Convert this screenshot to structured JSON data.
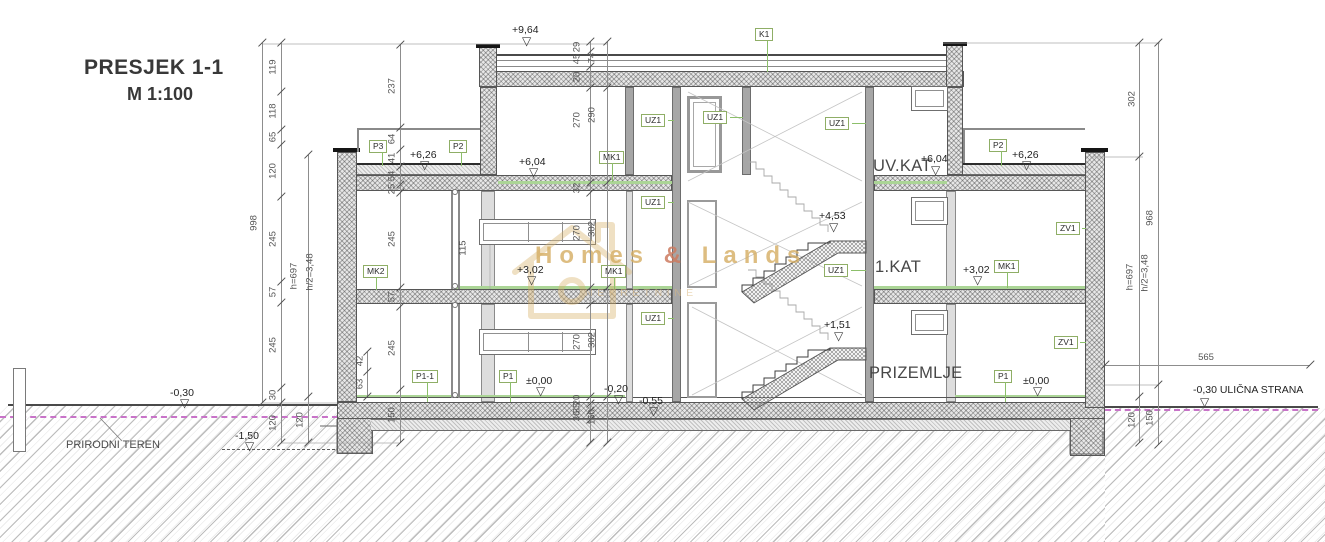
{
  "title": {
    "line1": "PRESJEK 1-1",
    "line2": "M 1:100"
  },
  "floor_names": [
    {
      "t": "UV.KAT",
      "x": 873,
      "y": 157
    },
    {
      "t": "1.KAT",
      "x": 875,
      "y": 258
    },
    {
      "t": "PRIZEMLJE",
      "x": 869,
      "y": 364
    }
  ],
  "level_symbol": "▽",
  "levels": [
    {
      "t": "+9,64",
      "x": 512,
      "y": 24,
      "tx": 522,
      "ty": 36
    },
    {
      "t": "+6,26",
      "x": 410,
      "y": 149,
      "tx": 420,
      "ty": 160
    },
    {
      "t": "+6,04",
      "x": 519,
      "y": 156,
      "tx": 529,
      "ty": 167
    },
    {
      "t": "+6,04",
      "x": 921,
      "y": 153,
      "tx": 931,
      "ty": 165
    },
    {
      "t": "+6,26",
      "x": 1012,
      "y": 149,
      "tx": 1022,
      "ty": 160
    },
    {
      "t": "+4,53",
      "x": 819,
      "y": 210,
      "tx": 829,
      "ty": 222
    },
    {
      "t": "+3,02",
      "x": 517,
      "y": 264,
      "tx": 527,
      "ty": 275
    },
    {
      "t": "+3,02",
      "x": 963,
      "y": 264,
      "tx": 973,
      "ty": 275
    },
    {
      "t": "+1,51",
      "x": 824,
      "y": 319,
      "tx": 834,
      "ty": 331
    },
    {
      "t": "±0,00",
      "x": 526,
      "y": 375,
      "tx": 536,
      "ty": 386
    },
    {
      "t": "±0,00",
      "x": 1023,
      "y": 375,
      "tx": 1033,
      "ty": 386
    },
    {
      "t": "-0,20",
      "x": 604,
      "y": 383,
      "tx": 614,
      "ty": 394
    },
    {
      "t": "-0,55",
      "x": 639,
      "y": 395,
      "tx": 649,
      "ty": 406
    },
    {
      "t": "-0,30",
      "x": 170,
      "y": 387,
      "tx": 180,
      "ty": 398
    },
    {
      "t": "-0,30  ULIČNA STRANA",
      "x": 1193,
      "y": 384,
      "tx": 1200,
      "ty": 397
    },
    {
      "t": "-1,50",
      "x": 235,
      "y": 430,
      "tx": 245,
      "ty": 441
    }
  ],
  "tags": [
    {
      "t": "P3",
      "x": 369,
      "y": 140,
      "ldr": [
        382,
        152,
        14,
        "v"
      ]
    },
    {
      "t": "P2",
      "x": 449,
      "y": 140,
      "ldr": [
        461,
        152,
        14,
        "v"
      ]
    },
    {
      "t": "P2",
      "x": 989,
      "y": 139,
      "ldr": [
        1001,
        151,
        15,
        "v"
      ]
    },
    {
      "t": "K1",
      "x": 755,
      "y": 28,
      "ldr": [
        767,
        41,
        31,
        "v"
      ]
    },
    {
      "t": "UZ1",
      "x": 641,
      "y": 114,
      "ldr": [
        668,
        120,
        6,
        "h"
      ]
    },
    {
      "t": "UZ1",
      "x": 703,
      "y": 111,
      "ldr": [
        730,
        117,
        13,
        "h"
      ]
    },
    {
      "t": "UZ1",
      "x": 825,
      "y": 117,
      "ldr": [
        852,
        123,
        14,
        "h"
      ]
    },
    {
      "t": "MK1",
      "x": 599,
      "y": 151,
      "ldr": [
        612,
        163,
        19,
        "v"
      ]
    },
    {
      "t": "UZ1",
      "x": 641,
      "y": 196,
      "ldr": [
        668,
        202,
        6,
        "h"
      ]
    },
    {
      "t": "MK2",
      "x": 363,
      "y": 265,
      "ldr": [
        376,
        277,
        13,
        "v"
      ]
    },
    {
      "t": "MK1",
      "x": 601,
      "y": 265,
      "ldr": [
        614,
        277,
        12,
        "v"
      ]
    },
    {
      "t": "UZ1",
      "x": 824,
      "y": 264,
      "ldr": [
        851,
        270,
        15,
        "h"
      ]
    },
    {
      "t": "MK1",
      "x": 994,
      "y": 260,
      "ldr": [
        1007,
        272,
        16,
        "v"
      ]
    },
    {
      "t": "ZV1",
      "x": 1056,
      "y": 222,
      "ldr": [
        1082,
        228,
        4,
        "h"
      ]
    },
    {
      "t": "UZ1",
      "x": 641,
      "y": 312,
      "ldr": [
        668,
        318,
        6,
        "h"
      ]
    },
    {
      "t": "ZV1",
      "x": 1054,
      "y": 336,
      "ldr": [
        1080,
        342,
        6,
        "h"
      ]
    },
    {
      "t": "P1-1",
      "x": 412,
      "y": 370,
      "ldr": [
        427,
        382,
        20,
        "v"
      ]
    },
    {
      "t": "P1",
      "x": 499,
      "y": 370,
      "ldr": [
        510,
        382,
        20,
        "v"
      ]
    },
    {
      "t": "P1",
      "x": 994,
      "y": 370,
      "ldr": [
        1005,
        382,
        20,
        "v"
      ]
    }
  ],
  "vchains": [
    {
      "x": 262,
      "y1": 43,
      "y2": 403,
      "ticks": [
        43,
        403
      ],
      "labels": [
        {
          "t": "998",
          "y": 223,
          "dx": -8
        }
      ]
    },
    {
      "x": 281,
      "y1": 43,
      "y2": 443,
      "ticks": [
        43,
        92,
        130,
        145,
        197,
        282,
        303,
        388,
        403,
        443
      ],
      "labels": [
        {
          "t": "119",
          "y": 67,
          "dx": -8
        },
        {
          "t": "118",
          "y": 111,
          "dx": -8
        },
        {
          "t": "65",
          "y": 137,
          "dx": -8
        },
        {
          "t": "120",
          "y": 171,
          "dx": -8
        },
        {
          "t": "245",
          "y": 239,
          "dx": -8
        },
        {
          "t": "57",
          "y": 292,
          "dx": -8
        },
        {
          "t": "245",
          "y": 345,
          "dx": -8
        },
        {
          "t": "30",
          "y": 395,
          "dx": -8
        },
        {
          "t": "120",
          "y": 423,
          "dx": -8
        }
      ]
    },
    {
      "x": 308,
      "y1": 155,
      "y2": 443,
      "ticks": [
        155,
        397,
        443
      ],
      "labels": [
        {
          "t": "h=697",
          "y": 276,
          "dx": -14
        },
        {
          "t": "h/2=3,48",
          "y": 272,
          "dx": 2
        },
        {
          "t": "120",
          "y": 420,
          "dx": -8
        }
      ]
    },
    {
      "x": 367,
      "y1": 352,
      "y2": 397,
      "ticks": [
        352,
        372,
        397
      ],
      "labels": [
        {
          "t": "42",
          "y": 361,
          "dx": -7
        },
        {
          "t": "63",
          "y": 384,
          "dx": -7
        }
      ]
    },
    {
      "x": 400,
      "y1": 45,
      "y2": 443,
      "ticks": [
        45,
        128,
        150,
        167,
        185,
        193,
        288,
        307,
        390,
        443
      ],
      "labels": [
        {
          "t": "237",
          "y": 86,
          "dx": -8
        },
        {
          "t": "64",
          "y": 139,
          "dx": -8
        },
        {
          "t": "41",
          "y": 158,
          "dx": -8
        },
        {
          "t": "54",
          "y": 176,
          "dx": -8
        },
        {
          "t": "25",
          "y": 189,
          "dx": -8
        },
        {
          "t": "245",
          "y": 239,
          "dx": -8
        },
        {
          "t": "57",
          "y": 297,
          "dx": -8
        },
        {
          "t": "245",
          "y": 348,
          "dx": -8
        },
        {
          "t": "150",
          "y": 415,
          "dx": -8
        }
      ]
    },
    {
      "x": 590,
      "y1": 42,
      "y2": 443,
      "ticks": [
        42,
        52,
        67,
        88,
        183,
        193,
        288,
        305,
        397,
        404,
        411,
        420,
        443
      ],
      "labels": [
        {
          "t": "29",
          "y": 47,
          "dx": -13
        },
        {
          "t": "45",
          "y": 59,
          "dx": -13
        },
        {
          "t": "20",
          "y": 77,
          "dx": -13
        },
        {
          "t": "270",
          "y": 120,
          "dx": -13
        },
        {
          "t": "32",
          "y": 188,
          "dx": -13
        },
        {
          "t": "270",
          "y": 233,
          "dx": -13
        },
        {
          "t": "270",
          "y": 342,
          "dx": -13
        },
        {
          "t": "20",
          "y": 400,
          "dx": -13
        },
        {
          "t": "35",
          "y": 408,
          "dx": -13
        },
        {
          "t": "36",
          "y": 416,
          "dx": -13
        }
      ]
    },
    {
      "x": 607,
      "y1": 42,
      "y2": 443,
      "ticks": [
        42,
        88,
        183,
        288,
        397,
        443
      ],
      "labels": [
        {
          "t": "74",
          "y": 58,
          "dx": -15
        },
        {
          "t": "290",
          "y": 115,
          "dx": -15
        },
        {
          "t": "302",
          "y": 229,
          "dx": -15
        },
        {
          "t": "302",
          "y": 340,
          "dx": -15
        },
        {
          "t": "150",
          "y": 417,
          "dx": -15
        }
      ]
    },
    {
      "x": 1139,
      "y1": 43,
      "y2": 443,
      "ticks": [
        43,
        157,
        397,
        443
      ],
      "labels": [
        {
          "t": "302",
          "y": 99,
          "dx": -7
        },
        {
          "t": "h=697",
          "y": 277,
          "dx": -9
        },
        {
          "t": "h/2=3,48",
          "y": 273,
          "dx": 6
        },
        {
          "t": "120",
          "y": 420,
          "dx": -7
        }
      ]
    },
    {
      "x": 1158,
      "y1": 43,
      "y2": 445,
      "ticks": [
        43,
        385,
        445
      ],
      "labels": [
        {
          "t": "968",
          "y": 218,
          "dx": -8
        },
        {
          "t": "150",
          "y": 418,
          "dx": -8
        }
      ]
    }
  ],
  "hchains": [
    {
      "y": 365,
      "x1": 1105,
      "x2": 1310,
      "ticks": [
        1105,
        1310
      ],
      "labels": [
        {
          "t": "565",
          "x": 1206,
          "dy": -13
        }
      ]
    }
  ],
  "notes": [
    {
      "t": "PRIRODNI TEREN",
      "x": 66,
      "y": 439,
      "size": 11,
      "rot": false
    },
    {
      "t": "115",
      "x": 463,
      "y": 248,
      "size": 9.5,
      "rot": true
    }
  ],
  "watermark": {
    "pre": "Homes",
    "amp": "&",
    "post": "Lands",
    "sub": "NEKRETNINE"
  },
  "colors": {
    "tag_border_green": "#8fae66",
    "leader_green": "#8cbf6a",
    "floor_finish_green": "#abd596",
    "terrain_magenta": "#c873c8",
    "watermark_gold": "#d4ac62",
    "line_dark": "#4a4a4a"
  }
}
